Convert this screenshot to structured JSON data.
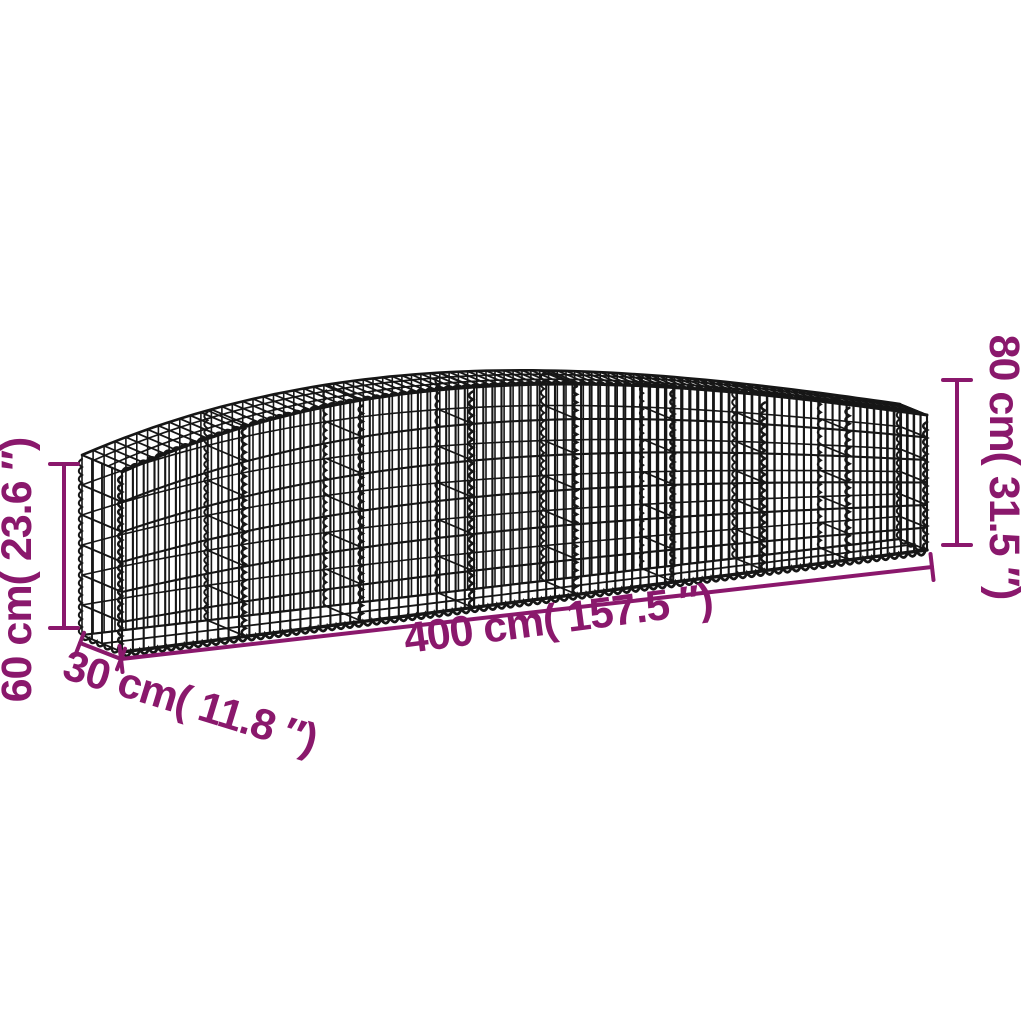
{
  "diagram": {
    "type": "product-dimension-diagram",
    "subject": "arched gabion wire mesh basket",
    "background_color": "#ffffff",
    "wire_color": "#161616",
    "dimension_color": "#8A186C"
  },
  "dimensions": {
    "length": {
      "label": "400 cm( 157.5 ″)",
      "value_cm": 400,
      "value_in": 157.5
    },
    "depth": {
      "label": "30 cm( 11.8 ″)",
      "value_cm": 30,
      "value_in": 11.8
    },
    "height_end": {
      "label": "60 cm( 23.6 ″)",
      "value_cm": 60,
      "value_in": 23.6
    },
    "height_peak": {
      "label": "80 cm( 31.5 ″)",
      "value_cm": 80,
      "value_in": 31.5
    }
  }
}
